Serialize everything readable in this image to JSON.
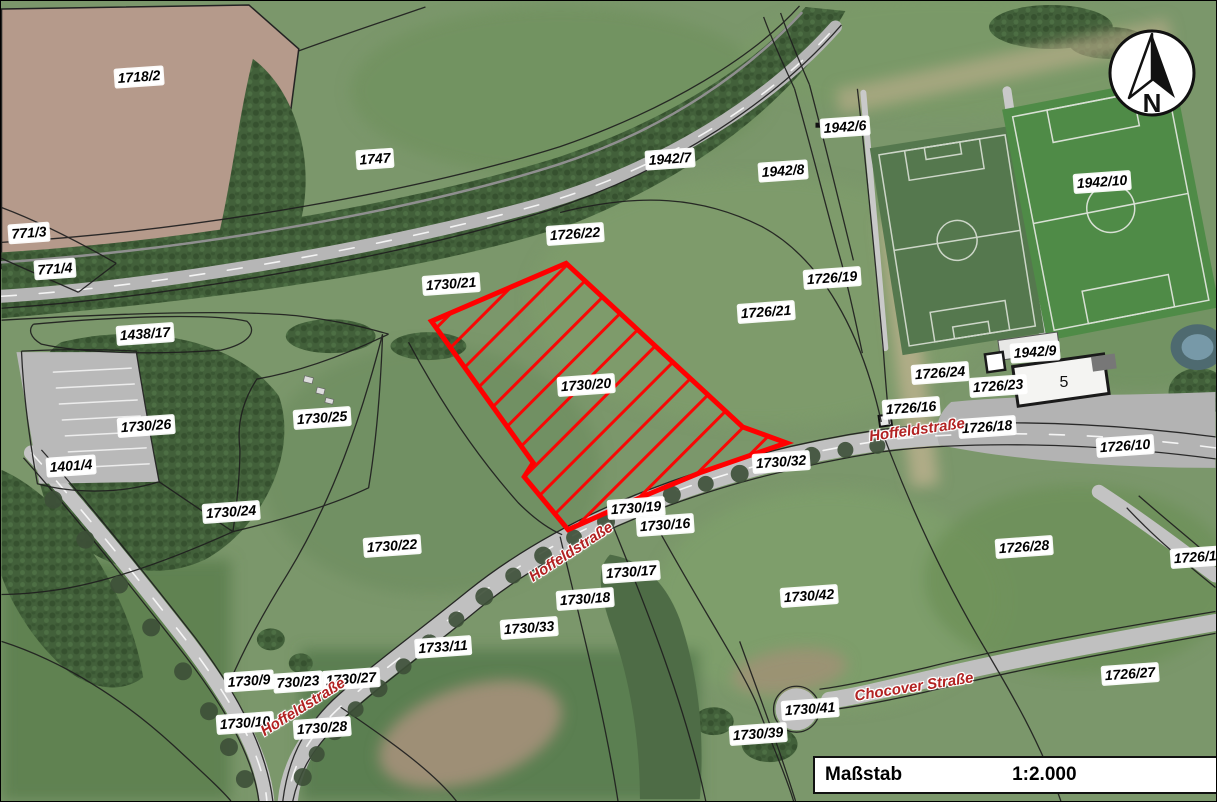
{
  "map": {
    "title": "Cadastral aerial map",
    "highlight_color": "#ff0000",
    "boundary_color": "#1f1f1f",
    "street_label_color": "#b22222",
    "highlight_parcel": {
      "label": "1730/20",
      "points": "566,263 743,427 787,443 700,473 640,498 568,530 524,477 533,463 431,321"
    },
    "parcels": [
      {
        "label": "1718/2",
        "x": 138,
        "y": 76
      },
      {
        "label": "1747",
        "x": 374,
        "y": 158
      },
      {
        "label": "771/3",
        "x": 28,
        "y": 232
      },
      {
        "label": "771/4",
        "x": 54,
        "y": 268
      },
      {
        "label": "1438/17",
        "x": 144,
        "y": 333
      },
      {
        "label": "1730/26",
        "x": 145,
        "y": 425
      },
      {
        "label": "1401/4",
        "x": 70,
        "y": 465
      },
      {
        "label": "1730/25",
        "x": 321,
        "y": 417
      },
      {
        "label": "1730/24",
        "x": 230,
        "y": 511
      },
      {
        "label": "1730/22",
        "x": 391,
        "y": 545
      },
      {
        "label": "1730/21",
        "x": 450,
        "y": 283
      },
      {
        "label": "1726/22",
        "x": 574,
        "y": 233
      },
      {
        "label": "1942/7",
        "x": 669,
        "y": 158
      },
      {
        "label": "1942/8",
        "x": 782,
        "y": 170
      },
      {
        "label": "1942/6",
        "x": 844,
        "y": 126
      },
      {
        "label": "1942/10",
        "x": 1101,
        "y": 181
      },
      {
        "label": "1726/19",
        "x": 831,
        "y": 277
      },
      {
        "label": "1726/21",
        "x": 765,
        "y": 311
      },
      {
        "label": "1730/20",
        "x": 585,
        "y": 384
      },
      {
        "label": "1726/24",
        "x": 939,
        "y": 372
      },
      {
        "label": "1942/9",
        "x": 1034,
        "y": 351
      },
      {
        "label": "1726/23",
        "x": 997,
        "y": 385
      },
      {
        "label": "1726/16",
        "x": 910,
        "y": 407
      },
      {
        "label": "1726/18",
        "x": 986,
        "y": 426
      },
      {
        "label": "1726/10",
        "x": 1124,
        "y": 445
      },
      {
        "label": "1730/32",
        "x": 780,
        "y": 461
      },
      {
        "label": "1730/19",
        "x": 635,
        "y": 507
      },
      {
        "label": "1730/16",
        "x": 664,
        "y": 524
      },
      {
        "label": "1730/17",
        "x": 630,
        "y": 571
      },
      {
        "label": "1730/18",
        "x": 584,
        "y": 598
      },
      {
        "label": "1730/33",
        "x": 528,
        "y": 627
      },
      {
        "label": "1733/11",
        "x": 442,
        "y": 646
      },
      {
        "label": "1726/28",
        "x": 1023,
        "y": 546
      },
      {
        "label": "1726/14",
        "x": 1198,
        "y": 556
      },
      {
        "label": "1730/42",
        "x": 808,
        "y": 595
      },
      {
        "label": "1730/27",
        "x": 350,
        "y": 678
      },
      {
        "label": "1730/9",
        "x": 248,
        "y": 680
      },
      {
        "label": "730/23",
        "x": 297,
        "y": 681
      },
      {
        "label": "1730/10",
        "x": 244,
        "y": 722
      },
      {
        "label": "1730/28",
        "x": 321,
        "y": 727
      },
      {
        "label": "1730/41",
        "x": 809,
        "y": 708
      },
      {
        "label": "1730/39",
        "x": 757,
        "y": 733
      },
      {
        "label": "1726/27",
        "x": 1129,
        "y": 673
      }
    ],
    "streets": [
      {
        "label": "Hoffeldstraße",
        "x": 916,
        "y": 429,
        "rot": -8
      },
      {
        "label": "Hoffeldstraße",
        "x": 570,
        "y": 551,
        "rot": -33
      },
      {
        "label": "Hoffeldstraße",
        "x": 302,
        "y": 706,
        "rot": -32
      },
      {
        "label": "Chocover Straße",
        "x": 913,
        "y": 686,
        "rot": -9
      }
    ],
    "building_label": {
      "label": "5",
      "x": 1063,
      "y": 382
    },
    "north": {
      "label": "N"
    },
    "scale": {
      "label": "Maßstab",
      "value": "1:2.000"
    }
  }
}
